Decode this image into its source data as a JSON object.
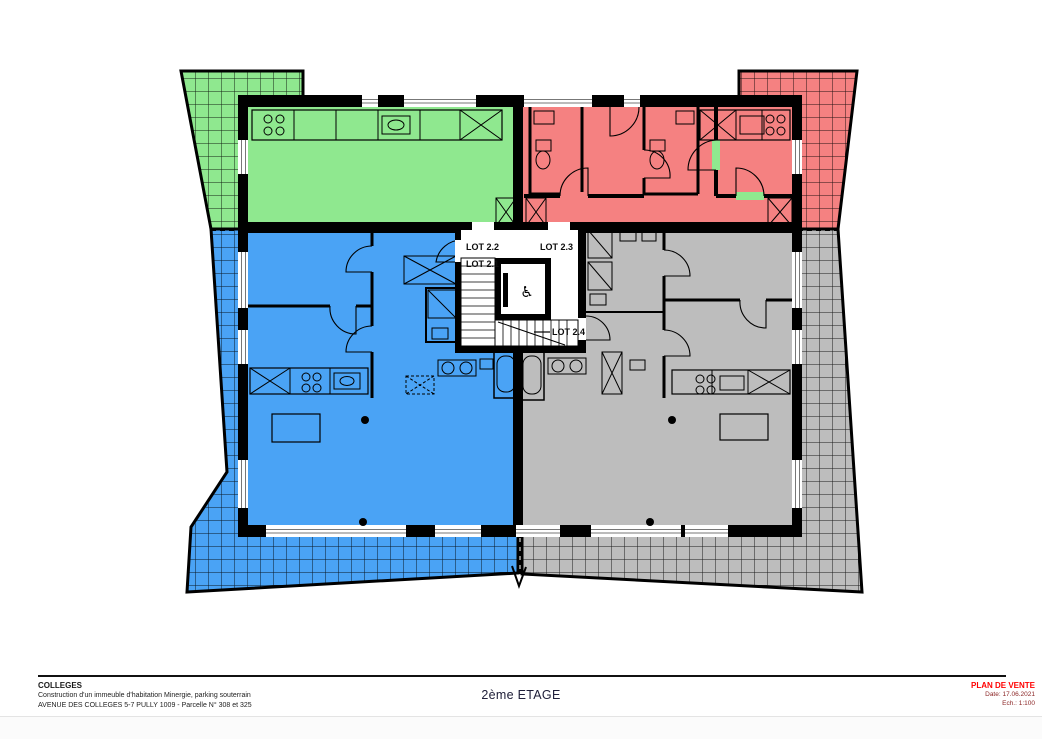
{
  "title_block": {
    "project_name": "COLLEGES",
    "project_description": "Construction d'un immeuble d'habitation Minergie, parking souterrain",
    "project_address": "AVENUE DES COLLEGES 5-7 PULLY 1009 - Parcelle N° 308 et 325",
    "floor_title": "2ème ETAGE",
    "stamp": {
      "title": "PLAN DE VENTE",
      "date": "Date: 17.06.2021",
      "scale": "Ech.: 1:100",
      "title_color": "#ff0000"
    }
  },
  "plan": {
    "wall_color": "#000000",
    "lots": [
      {
        "label": "LOT 2.2",
        "color": "#8fe88f",
        "area": "top-left apartment with west terrace"
      },
      {
        "label": "LOT 2.1",
        "color": "#4aa3f5",
        "area": "bottom-left apartment with wrap-around terrace"
      },
      {
        "label": "LOT 2.3",
        "color": "#f58181",
        "area": "top-right apartment with east terrace"
      },
      {
        "label": "LOT 2.4",
        "color": "#bdbdbd",
        "area": "bottom-right apartment with wrap-around terrace"
      }
    ],
    "core": {
      "elevator_icon": "♿"
    }
  }
}
